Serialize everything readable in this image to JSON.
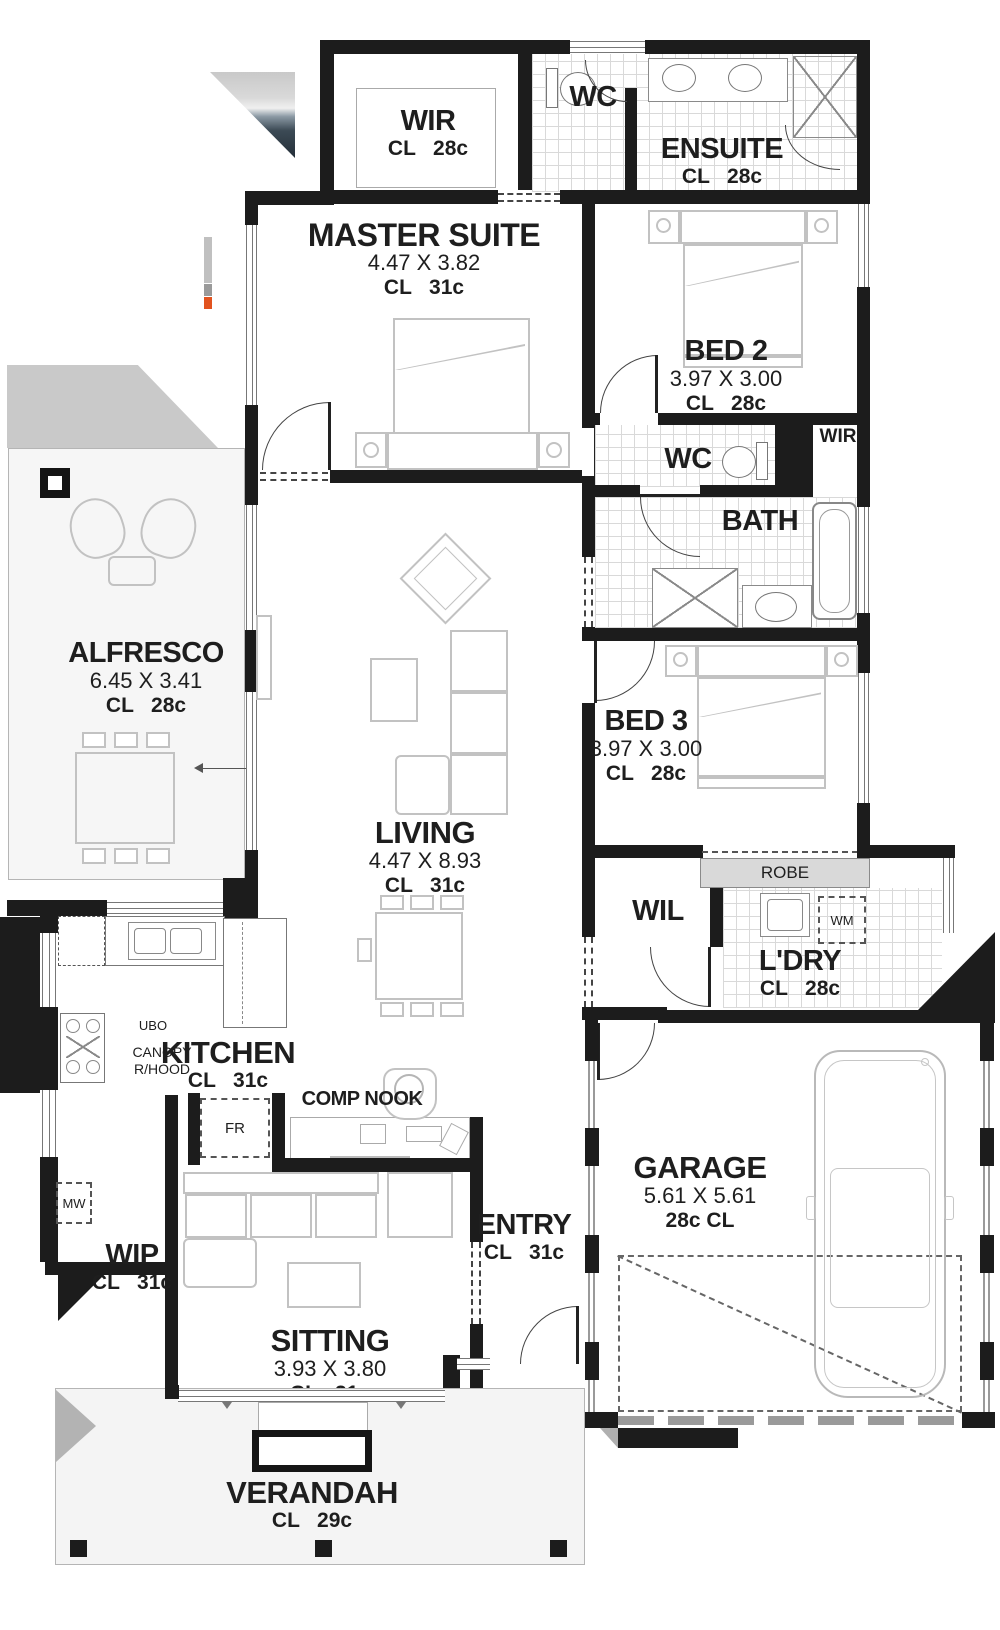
{
  "rooms": {
    "wir1": {
      "name": "WIR",
      "cl": "CL   28c"
    },
    "wc1": {
      "name": "WC"
    },
    "ensuite": {
      "name": "ENSUITE",
      "cl": "CL   28c"
    },
    "master": {
      "name": "MASTER SUITE",
      "dims": "4.47 X 3.82",
      "cl": "CL   31c"
    },
    "bed2": {
      "name": "BED 2",
      "dims": "3.97 X 3.00",
      "cl": "CL   28c"
    },
    "wir2": {
      "name": "WIR"
    },
    "wc2": {
      "name": "WC"
    },
    "bath": {
      "name": "BATH"
    },
    "alfresco": {
      "name": "ALFRESCO",
      "dims": "6.45 X 3.41",
      "cl": "CL   28c"
    },
    "bed3": {
      "name": "BED 3",
      "dims": "3.97 X 3.00",
      "cl": "CL   28c"
    },
    "living": {
      "name": "LIVING",
      "dims": "4.47 X 8.93",
      "cl": "CL   31c"
    },
    "wil": {
      "name": "WIL"
    },
    "robe": {
      "name": "ROBE"
    },
    "ldry": {
      "name": "L'DRY",
      "cl": "CL   28c"
    },
    "kitchen": {
      "name": "KITCHEN",
      "cl": "CL   31c"
    },
    "comp_nook": {
      "name": "COMP NOOK"
    },
    "garage": {
      "name": "GARAGE",
      "dims": "5.61 X 5.61",
      "cl": "28c CL"
    },
    "wip": {
      "name": "WIP",
      "cl": "CL   31c"
    },
    "entry": {
      "name": "ENTRY",
      "cl": "CL   31c"
    },
    "sitting": {
      "name": "SITTING",
      "dims": "3.93 X 3.80",
      "cl": "CL   31c"
    },
    "verandah": {
      "name": "VERANDAH",
      "cl": "CL   29c"
    }
  },
  "appliances": {
    "fridge": "FR",
    "microwave": "MW",
    "washing_machine": "WM",
    "under_bench_oven": "UBO",
    "canopy": "CANOPY",
    "rangehood": "R/HOOD"
  },
  "colors": {
    "wall": "#1c1c1c",
    "tile_line": "#d9d9d9",
    "furniture_line": "#c2c2c2",
    "slab": "#f4f4f4",
    "robe_banner": "#d9d9d9"
  }
}
